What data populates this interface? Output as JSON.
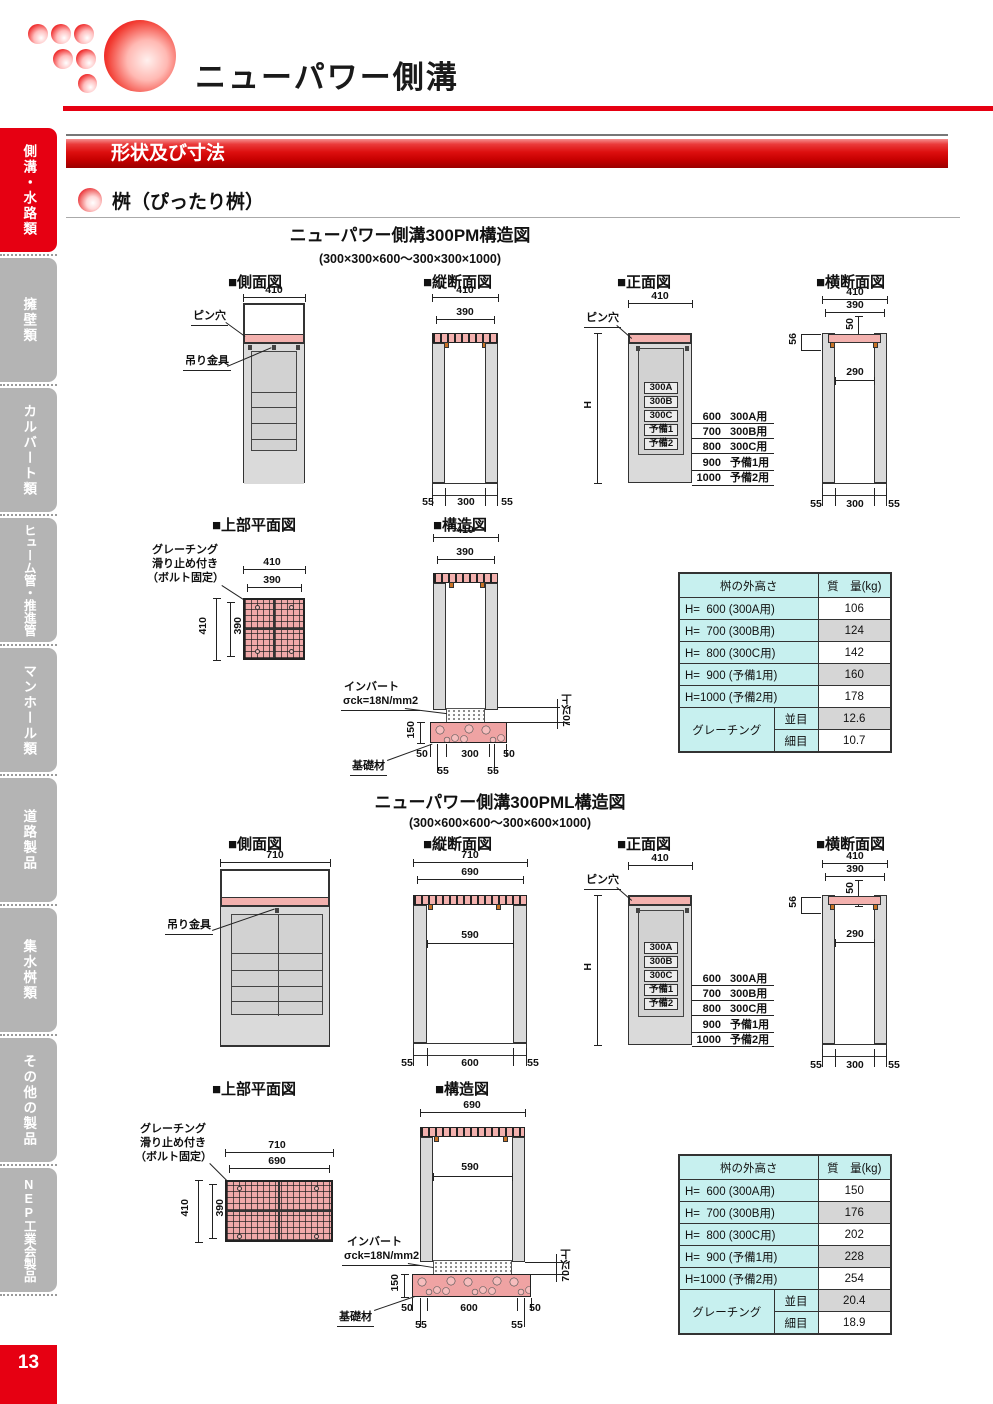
{
  "header": {
    "title": "ニューパワー側溝",
    "banner": "形状及び寸法",
    "subsection": "桝（ぴったり桝）",
    "accent_color": "#e60012"
  },
  "sidebar": {
    "items": [
      {
        "label": "側溝・水路類",
        "active": true
      },
      {
        "label": "擁壁類",
        "active": false
      },
      {
        "label": "カルバート類",
        "active": false
      },
      {
        "label": "ヒューム管・推進管",
        "active": false
      },
      {
        "label": "マンホール類",
        "active": false
      },
      {
        "label": "道路製品",
        "active": false
      },
      {
        "label": "集水桝類",
        "active": false
      },
      {
        "label": "その他の製品",
        "active": false
      },
      {
        "label": "NEP工業会製品",
        "active": false
      }
    ],
    "page_number": "13"
  },
  "s1": {
    "title": "ニューパワー側溝300PM構造図",
    "subtitle": "(300×300×600～300×300×1000)",
    "side": {
      "title": "■側面図",
      "w": "410",
      "pin": "ピン穴",
      "hanger": "吊り金具"
    },
    "long": {
      "title": "■縦断面図",
      "w1": "410",
      "w2": "390",
      "bl": "55",
      "bc": "300",
      "br": "55"
    },
    "front": {
      "title": "■正面図",
      "w": "410",
      "pin": "ピン穴",
      "h": "H",
      "types": [
        "300A",
        "300B",
        "300C",
        "予備1",
        "予備2"
      ],
      "heights": [
        {
          "v": "600",
          "u": "300A用"
        },
        {
          "v": "700",
          "u": "300B用"
        },
        {
          "v": "800",
          "u": "300C用"
        },
        {
          "v": "900",
          "u": "予備1用"
        },
        {
          "v": "1000",
          "u": "予備2用"
        }
      ]
    },
    "cross": {
      "title": "■横断面図",
      "w1": "410",
      "w2": "390",
      "d50": "50",
      "d56": "56",
      "inner": "290",
      "bl": "55",
      "bc": "300",
      "br": "55"
    },
    "plan": {
      "title": "■上部平面図",
      "note1": "グレーチング",
      "note2": "滑り止め付き",
      "note3": "（ボルト固定）",
      "w1": "410",
      "w2": "390",
      "v1": "410",
      "v2": "390"
    },
    "struct": {
      "title": "■構造図",
      "w1": "410",
      "w2": "390",
      "invert": "インバート",
      "sigma": "σck=18N/mm2",
      "fh": "150",
      "min70": "70以上",
      "base": "基礎材",
      "b50l": "50",
      "b300": "300",
      "b50r": "50",
      "b55l": "55",
      "b55r": "55"
    },
    "table": {
      "col1": "桝の外高さ",
      "col2": "質　量(kg)",
      "rows": [
        {
          "label": "H=  600 (300A用)",
          "value": "106"
        },
        {
          "label": "H=  700 (300B用)",
          "value": "124"
        },
        {
          "label": "H=  800 (300C用)",
          "value": "142"
        },
        {
          "label": "H=  900 (予備1用)",
          "value": "160"
        },
        {
          "label": "H=1000 (予備2用)",
          "value": "178"
        }
      ],
      "grating": "グレーチング",
      "coarse": {
        "label": "並目",
        "value": "12.6"
      },
      "fine": {
        "label": "細目",
        "value": "10.7"
      }
    }
  },
  "s2": {
    "title": "ニューパワー側溝300PML構造図",
    "subtitle": "(300×600×600～300×600×1000)",
    "side": {
      "title": "■側面図",
      "w": "710",
      "hanger": "吊り金具"
    },
    "long": {
      "title": "■縦断面図",
      "w1": "710",
      "w2": "690",
      "inner": "590",
      "bl": "55",
      "bc": "600",
      "br": "55"
    },
    "front": {
      "title": "■正面図",
      "w": "410",
      "pin": "ピン穴",
      "h": "H",
      "types": [
        "300A",
        "300B",
        "300C",
        "予備1",
        "予備2"
      ],
      "heights": [
        {
          "v": "600",
          "u": "300A用"
        },
        {
          "v": "700",
          "u": "300B用"
        },
        {
          "v": "800",
          "u": "300C用"
        },
        {
          "v": "900",
          "u": "予備1用"
        },
        {
          "v": "1000",
          "u": "予備2用"
        }
      ]
    },
    "cross": {
      "title": "■横断面図",
      "w1": "410",
      "w2": "390",
      "d50": "50",
      "d56": "56",
      "inner": "290",
      "bl": "55",
      "bc": "300",
      "br": "55"
    },
    "plan": {
      "title": "■上部平面図",
      "note1": "グレーチング",
      "note2": "滑り止め付き",
      "note3": "（ボルト固定）",
      "w1": "710",
      "w2": "690",
      "v1": "410",
      "v2": "390"
    },
    "struct": {
      "title": "■構造図",
      "w1": "690",
      "inner": "590",
      "invert": "インバート",
      "sigma": "σck=18N/mm2",
      "fh": "150",
      "min70": "70以上",
      "base": "基礎材",
      "b50l": "50",
      "b600": "600",
      "b50r": "50",
      "b55l": "55",
      "b55r": "55"
    },
    "table": {
      "col1": "桝の外高さ",
      "col2": "質　量(kg)",
      "rows": [
        {
          "label": "H=  600 (300A用)",
          "value": "150"
        },
        {
          "label": "H=  700 (300B用)",
          "value": "176"
        },
        {
          "label": "H=  800 (300C用)",
          "value": "202"
        },
        {
          "label": "H=  900 (予備1用)",
          "value": "228"
        },
        {
          "label": "H=1000 (予備2用)",
          "value": "254"
        }
      ],
      "grating": "グレーチング",
      "coarse": {
        "label": "並目",
        "value": "20.4"
      },
      "fine": {
        "label": "細目",
        "value": "18.9"
      }
    }
  }
}
